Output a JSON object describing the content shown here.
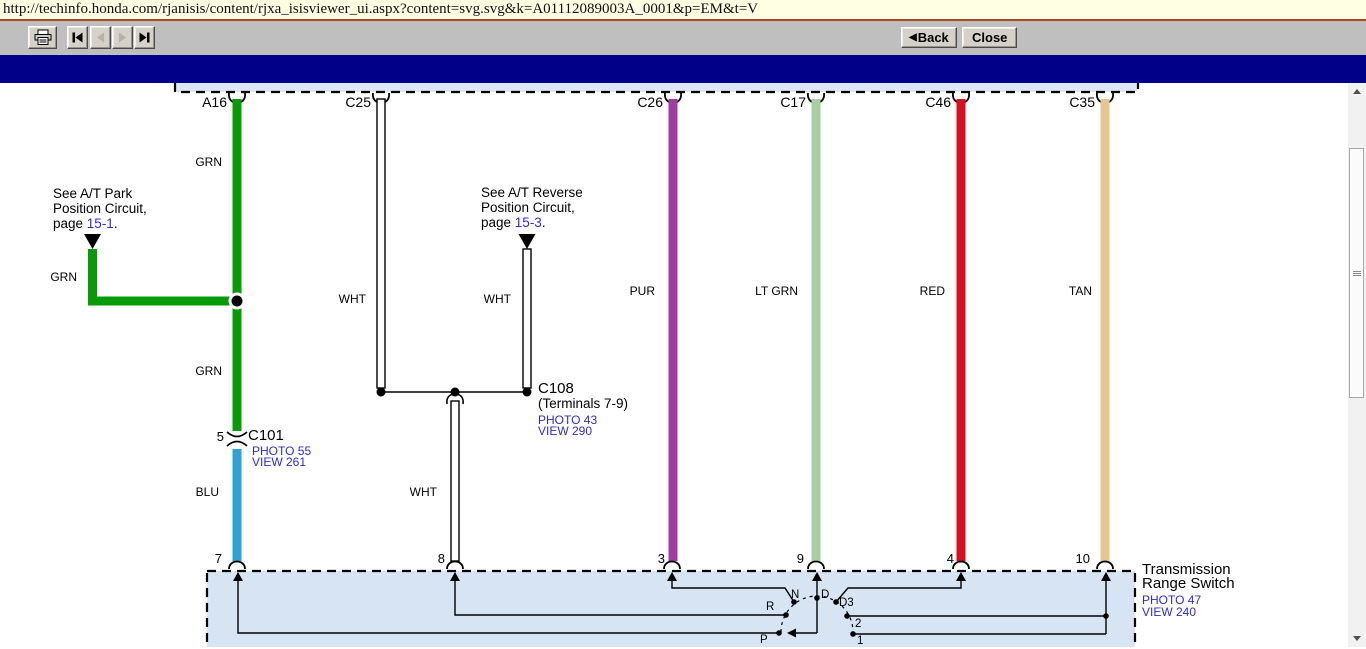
{
  "browser": {
    "url": "http://techinfo.honda.com/rjanisis/content/rjxa_isisviewer_ui.aspx?content=svg.svg&k=A01112089003A_0001&p=EM&t=V",
    "back_label": "Back",
    "close_label": "Close",
    "back_arrow_glyph": "◀"
  },
  "colors": {
    "green": "#089b08",
    "blue": "#2ea2d6",
    "purple": "#a03da0",
    "light_green": "#a9cfa1",
    "red": "#d6101c",
    "tan": "#e5c78f",
    "white_wire": "#ffffff",
    "link_blue": "#2c2cd0",
    "navy_band": "#000089",
    "component_fill": "#d6e4f4"
  },
  "diagram": {
    "connector_labels": {
      "a16": "A16",
      "c25": "C25",
      "c26": "C26",
      "c17": "C17",
      "c46": "C46",
      "c35": "C35"
    },
    "wire_colors": {
      "grn": "GRN",
      "wht": "WHT",
      "blu": "BLU",
      "pur": "PUR",
      "lt_grn": "LT GRN",
      "red": "RED",
      "tan": "TAN"
    },
    "park_note": {
      "line1": "See A/T Park",
      "line2": "Position Circuit,",
      "page_prefix": "page ",
      "page_link": "15-1",
      "period": "."
    },
    "reverse_note": {
      "line1": "See A/T Reverse",
      "line2": "Position Circuit,",
      "page_prefix": "page ",
      "page_link": "15-3",
      "period": "."
    },
    "c101": {
      "terminal_top": "5",
      "name": "C101",
      "photo": "PHOTO 55",
      "view": "VIEW 261"
    },
    "c108": {
      "name": "C108",
      "detail": "(Terminals 7-9)",
      "photo": "PHOTO 43",
      "view": "VIEW 290"
    },
    "switch": {
      "name_line1": "Transmission",
      "name_line2": "Range Switch",
      "photo": "PHOTO 47",
      "view": "VIEW 240",
      "terminals": {
        "t7": "7",
        "t8": "8",
        "t3": "3",
        "t9": "9",
        "t4": "4",
        "t10": "10"
      },
      "positions": {
        "p": "P",
        "r": "R",
        "n": "N",
        "d": "D",
        "d3": "D3",
        "pos2": "2",
        "pos1": "1"
      }
    }
  }
}
